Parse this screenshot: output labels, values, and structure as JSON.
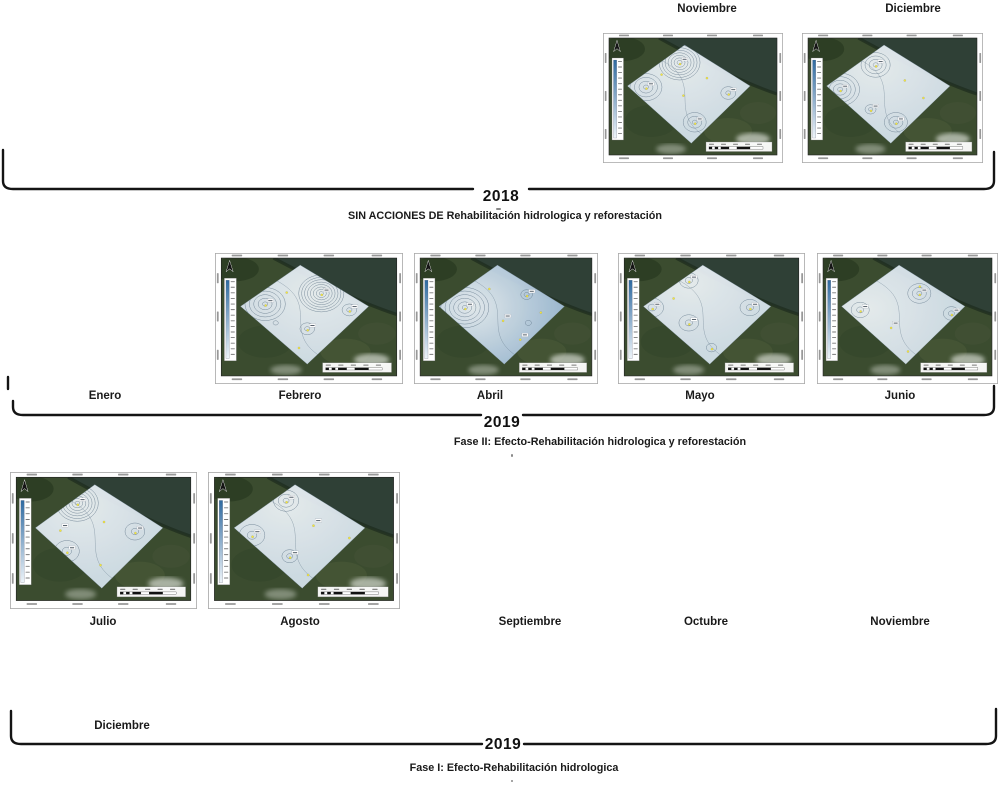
{
  "figure_title": "Timeline of piezometric interpolation maps with and without hydrological rehabilitation actions",
  "timeline": {
    "rows": [
      {
        "year": "2018",
        "phase_label": "SIN ACCIONES DE Rehabilitación hidrologica y reforestación",
        "months": [
          {
            "name": "Noviembre",
            "has_map": true
          },
          {
            "name": "Diciembre",
            "has_map": true
          }
        ]
      },
      {
        "year": "2019",
        "phase_label": "Fase II: Efecto-Rehabilitación hidrologica y reforestación",
        "months": [
          {
            "name": "Enero",
            "has_map": false
          },
          {
            "name": "Febrero",
            "has_map": true
          },
          {
            "name": "Abril",
            "has_map": true
          },
          {
            "name": "Mayo",
            "has_map": true
          },
          {
            "name": "Junio",
            "has_map": true
          }
        ]
      },
      {
        "year": "2019",
        "phase_label": "Fase I: Efecto-Rehabilitación hidrologica",
        "months": [
          {
            "name": "Julio",
            "has_map": true
          },
          {
            "name": "Agosto",
            "has_map": true
          },
          {
            "name": "Septiembre",
            "has_map": false
          },
          {
            "name": "Octubre",
            "has_map": false
          },
          {
            "name": "Noviembre",
            "has_map": false
          },
          {
            "name": "Diciembre",
            "has_map": false
          }
        ]
      }
    ]
  },
  "colors": {
    "bracket": "#141414",
    "contour_line": "#5d7386",
    "diamond_pale_center": "#f1f6fa",
    "diamond_pale_edge": "#d8e5ef",
    "diamond_blue_center": "#eef4f9",
    "diamond_blue_edge": "#a7c3dd",
    "land_base": "#3b4c2f",
    "land_dark": "#26381f",
    "water": "#2f4036",
    "coast_fringe": "#1c2b1c",
    "cloud": "#d7dcd2",
    "legend_gradient_top": "#2f6aa0",
    "legend_gradient_bottom": "#eef4f9",
    "sample_point": "#f4e73b"
  },
  "maps": [
    {
      "id": "nov2018",
      "month": "Noviembre",
      "row": 0,
      "tint": "pale",
      "features": [
        {
          "x": 42,
          "y": 21,
          "n": 7,
          "r0": 2.5,
          "dr": 3
        },
        {
          "x": 22,
          "y": 42,
          "n": 4,
          "r0": 2.5,
          "dr": 4.5
        },
        {
          "x": 51,
          "y": 72,
          "n": 3,
          "r0": 2.5,
          "dr": 4.5
        },
        {
          "x": 71,
          "y": 47,
          "n": 2,
          "r0": 2.5,
          "dr": 5
        }
      ],
      "points": [
        [
          42,
          21
        ],
        [
          22,
          42
        ],
        [
          51,
          72
        ],
        [
          71,
          47
        ],
        [
          44,
          48
        ],
        [
          31,
          30
        ],
        [
          58,
          33
        ]
      ]
    },
    {
      "id": "dic2018",
      "month": "Diciembre",
      "row": 0,
      "tint": "pale",
      "features": [
        {
          "x": 40,
          "y": 23,
          "n": 4,
          "r0": 2.5,
          "dr": 4
        },
        {
          "x": 19,
          "y": 44,
          "n": 5,
          "r0": 2.5,
          "dr": 4.2
        },
        {
          "x": 37,
          "y": 61,
          "n": 2,
          "r0": 2,
          "dr": 3.5
        },
        {
          "x": 52,
          "y": 72,
          "n": 3,
          "r0": 2.5,
          "dr": 4.5
        }
      ],
      "points": [
        [
          40,
          23
        ],
        [
          19,
          44
        ],
        [
          37,
          61
        ],
        [
          52,
          72
        ],
        [
          57,
          35
        ],
        [
          68,
          50
        ]
      ]
    },
    {
      "id": "feb2019",
      "month": "Febrero",
      "row": 1,
      "tint": "pale",
      "features": [
        {
          "x": 57,
          "y": 30,
          "n": 8,
          "r0": 2,
          "dr": 2.8
        },
        {
          "x": 25,
          "y": 39,
          "n": 5,
          "r0": 2.5,
          "dr": 4.2
        },
        {
          "x": 49,
          "y": 60,
          "n": 2,
          "r0": 2.5,
          "dr": 4.5
        },
        {
          "x": 73,
          "y": 44,
          "n": 2,
          "r0": 2.5,
          "dr": 4.5
        },
        {
          "x": 31,
          "y": 55,
          "n": 1,
          "r0": 2.5,
          "dr": 4
        }
      ],
      "points": [
        [
          57,
          30
        ],
        [
          25,
          39
        ],
        [
          49,
          60
        ],
        [
          73,
          44
        ],
        [
          37,
          28
        ],
        [
          44,
          75
        ]
      ]
    },
    {
      "id": "abr2019",
      "month": "Abril",
      "row": 1,
      "tint": "blue",
      "features": [
        {
          "x": 26,
          "y": 42,
          "n": 6,
          "r0": 2.5,
          "dr": 4.2
        },
        {
          "x": 62,
          "y": 31,
          "n": 2,
          "r0": 2.5,
          "dr": 3.2
        },
        {
          "x": 63,
          "y": 55,
          "n": 1,
          "r0": 3,
          "dr": 4
        }
      ],
      "points": [
        [
          26,
          42
        ],
        [
          62,
          31
        ],
        [
          48,
          52
        ],
        [
          58,
          68
        ],
        [
          40,
          25
        ],
        [
          70,
          45
        ]
      ]
    },
    {
      "id": "may2019",
      "month": "Mayo",
      "row": 1,
      "tint": "pale",
      "features": [
        {
          "x": 37,
          "y": 19,
          "n": 2,
          "r0": 3.5,
          "dr": 5.5
        },
        {
          "x": 16,
          "y": 42,
          "n": 2,
          "r0": 4,
          "dr": 7
        },
        {
          "x": 37,
          "y": 55,
          "n": 2,
          "r0": 3.5,
          "dr": 6
        },
        {
          "x": 72,
          "y": 42,
          "n": 2,
          "r0": 3.5,
          "dr": 6
        },
        {
          "x": 50,
          "y": 76,
          "n": 1,
          "r0": 5,
          "dr": 6
        }
      ],
      "points": [
        [
          37,
          19
        ],
        [
          16,
          42
        ],
        [
          37,
          55
        ],
        [
          72,
          42
        ],
        [
          50,
          76
        ],
        [
          28,
          33
        ]
      ]
    },
    {
      "id": "jun2019",
      "month": "Junio",
      "row": 1,
      "tint": "pale",
      "features": [
        {
          "x": 22,
          "y": 44,
          "n": 2,
          "r0": 3.5,
          "dr": 5.5
        },
        {
          "x": 57,
          "y": 30,
          "n": 3,
          "r0": 2.5,
          "dr": 4.5
        },
        {
          "x": 76,
          "y": 47,
          "n": 2,
          "r0": 3,
          "dr": 5
        }
      ],
      "points": [
        [
          22,
          44
        ],
        [
          57,
          30
        ],
        [
          76,
          47
        ],
        [
          40,
          58
        ],
        [
          50,
          78
        ],
        [
          57,
          23
        ]
      ]
    },
    {
      "id": "jul2019",
      "month": "Julio",
      "row": 2,
      "tint": "pale",
      "features": [
        {
          "x": 35,
          "y": 21,
          "n": 7,
          "r0": 2.2,
          "dr": 3
        },
        {
          "x": 29,
          "y": 60,
          "n": 2,
          "r0": 4.5,
          "dr": 7.5
        },
        {
          "x": 68,
          "y": 44,
          "n": 2,
          "r0": 3.5,
          "dr": 6
        }
      ],
      "points": [
        [
          35,
          21
        ],
        [
          29,
          60
        ],
        [
          68,
          44
        ],
        [
          25,
          42
        ],
        [
          50,
          35
        ],
        [
          48,
          70
        ]
      ]
    },
    {
      "id": "ago2019",
      "month": "Agosto",
      "row": 2,
      "tint": "pale",
      "features": [
        {
          "x": 40,
          "y": 19,
          "n": 3,
          "r0": 2.8,
          "dr": 4.5
        },
        {
          "x": 21,
          "y": 47,
          "n": 2,
          "r0": 4.5,
          "dr": 7.5
        },
        {
          "x": 42,
          "y": 64,
          "n": 2,
          "r0": 2.8,
          "dr": 4.5
        }
      ],
      "points": [
        [
          40,
          19
        ],
        [
          21,
          47
        ],
        [
          42,
          64
        ],
        [
          55,
          38
        ],
        [
          75,
          48
        ],
        [
          52,
          78
        ]
      ]
    }
  ],
  "map_widgets": {
    "north_arrow": "north-arrow-icon",
    "legend": "elevation-legend-colorbar",
    "scale_bar": "scale-bar",
    "coordinate_ticks": "coordinate-grid-labels"
  }
}
